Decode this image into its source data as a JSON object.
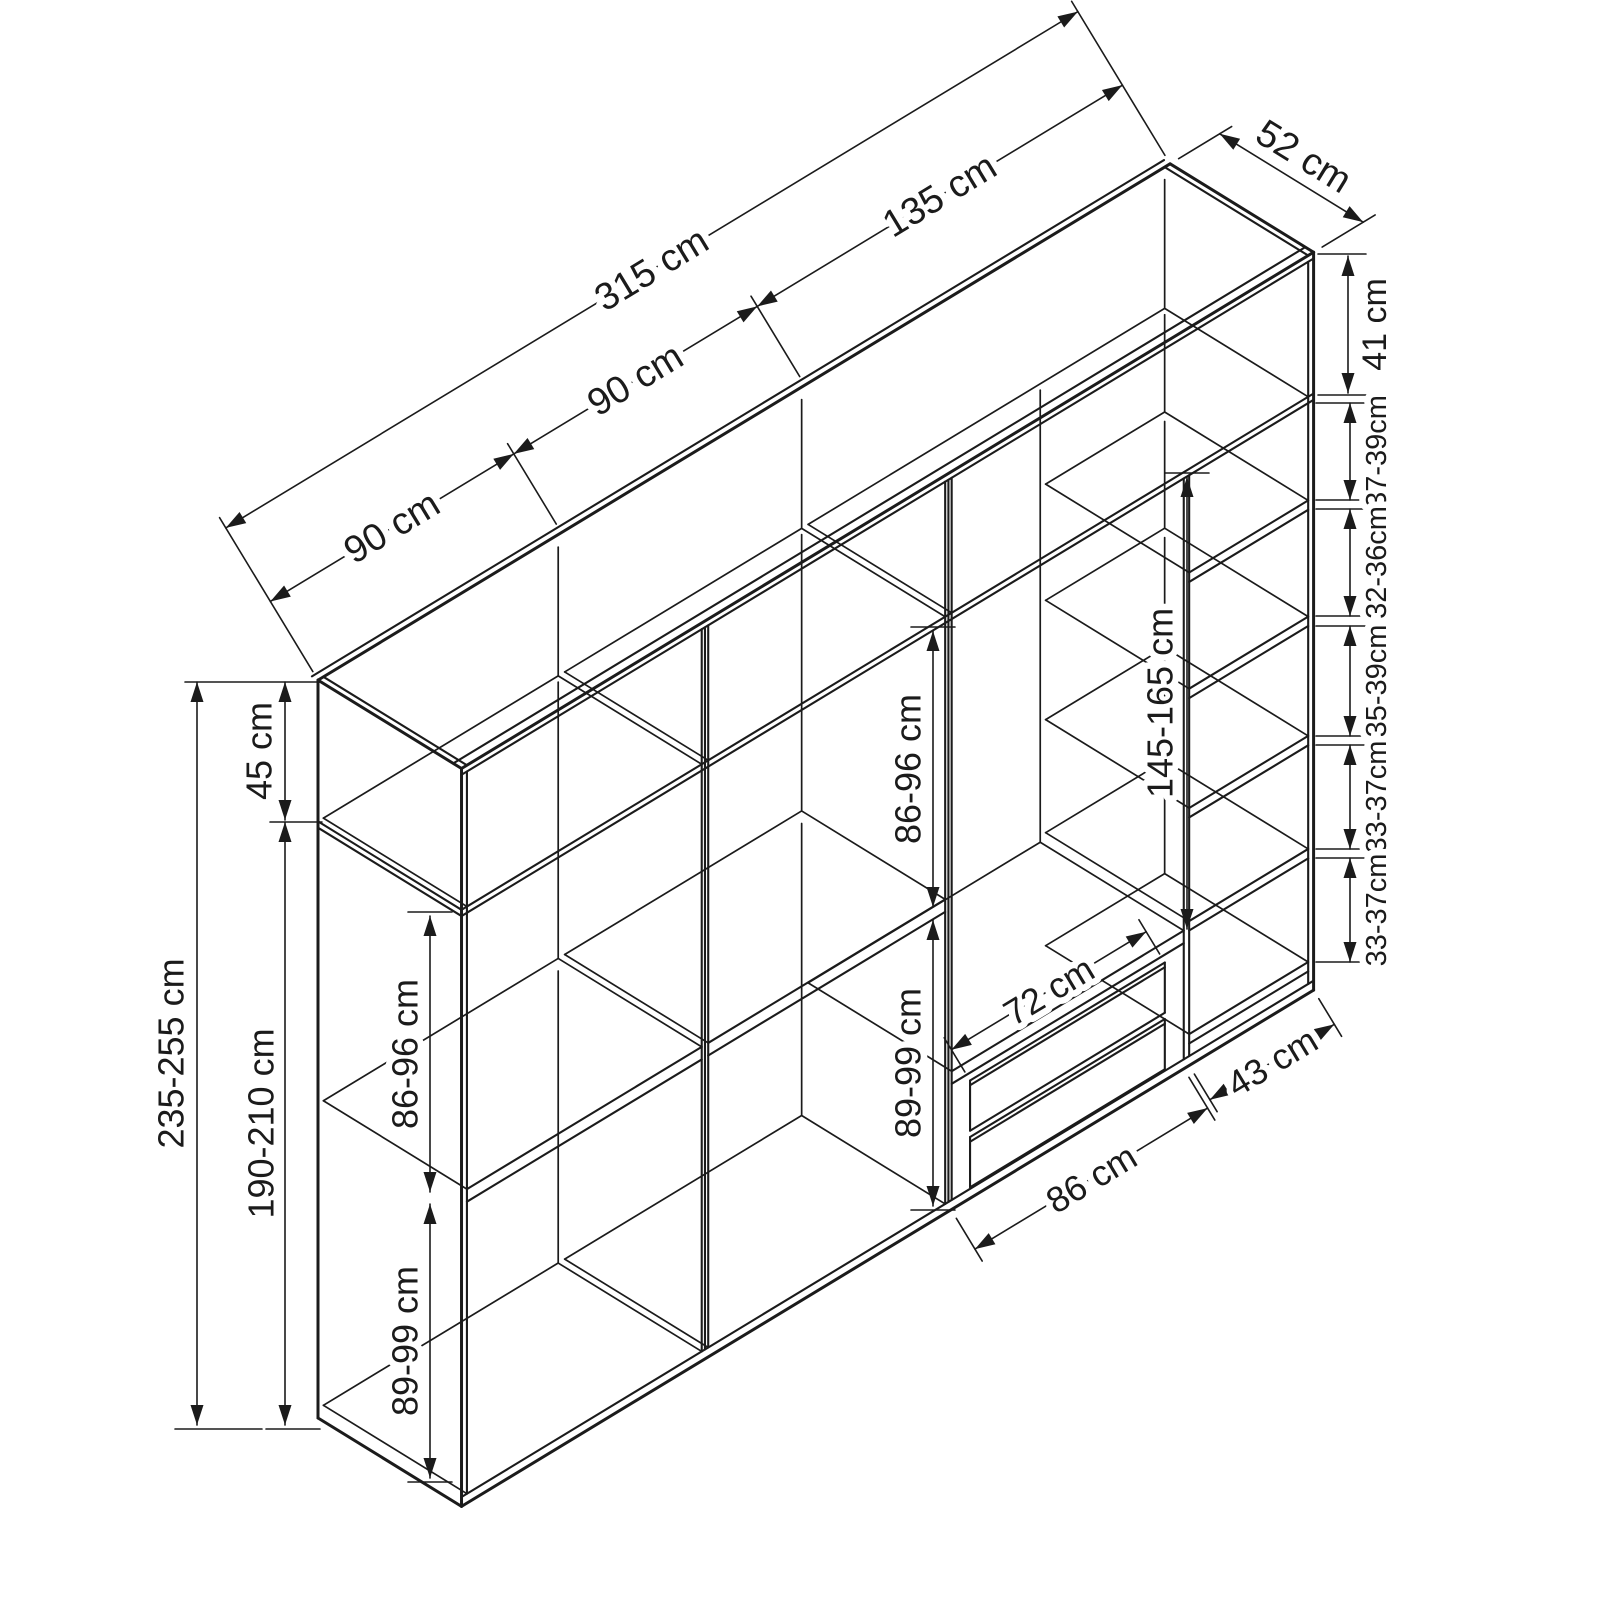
{
  "colors": {
    "ink": "#1b1b1b",
    "background": "#ffffff"
  },
  "diagram": {
    "kind": "isometric wardrobe dimension drawing",
    "units": "cm",
    "width_dims": {
      "left_section": "90 cm",
      "middle_section": "90 cm",
      "right_section": "135 cm",
      "total": "315 cm",
      "depth": "52 cm"
    },
    "height_dims": {
      "top_section": "45 cm",
      "lower_section": "190-210 cm",
      "total": "235-255 cm",
      "top_right_compartment": "41 cm"
    },
    "left_column": {
      "upper_compartment": "86-96 cm",
      "lower_compartment": "89-99 cm"
    },
    "middle_column": {
      "upper_compartment": "86-96 cm",
      "lower_compartment": "89-99 cm"
    },
    "hanging_section": {
      "height": "145-165 cm",
      "drawer_width": "72 cm",
      "section_width": "86 cm"
    },
    "right_column": {
      "width": "43 cm",
      "shelf_gaps": [
        "37-39cm",
        "32-36cm",
        "35-39cm",
        "33-37cm",
        "33-37cm"
      ]
    }
  }
}
